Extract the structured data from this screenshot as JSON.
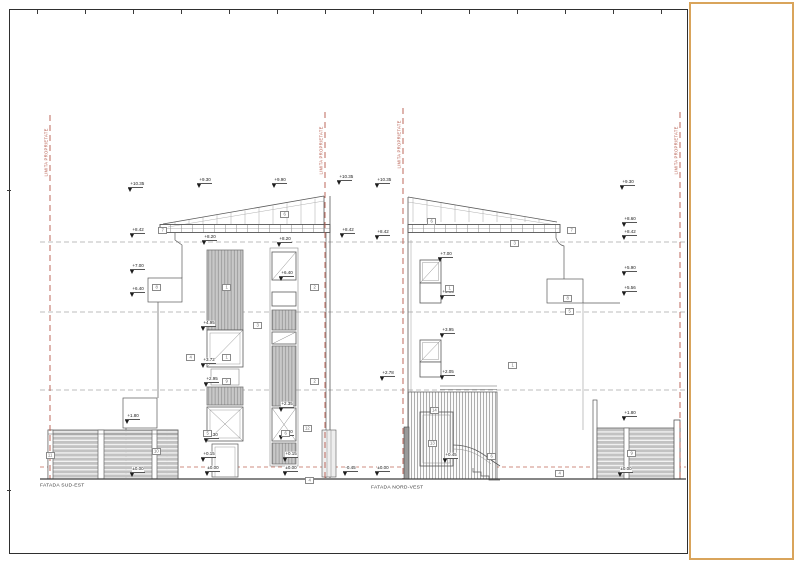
{
  "sheet": {
    "facade_left": "FATADA SUD-EST",
    "facade_right": "FATADA NORD-VEST",
    "property_line_text": "LIMITA PROPRIETATE"
  },
  "colors": {
    "property_line_red": "#b5584a",
    "ground_dash_red": "#c06a5a",
    "level_line_gray": "#a8a8a8",
    "linework": "#5a5a5a",
    "slat_fill": "#c8c8c8",
    "fold_panel_border": "#d9a45b"
  },
  "levels_left": [
    {
      "x": 128,
      "y": 192,
      "v": "+10.35"
    },
    {
      "x": 197,
      "y": 188,
      "v": "+9.30"
    },
    {
      "x": 272,
      "y": 188,
      "v": "+9.90"
    },
    {
      "x": 337,
      "y": 185,
      "v": "+10.35"
    },
    {
      "x": 130,
      "y": 238,
      "v": "+8.42"
    },
    {
      "x": 340,
      "y": 238,
      "v": "+8.42"
    },
    {
      "x": 202,
      "y": 245,
      "v": "+8.20"
    },
    {
      "x": 277,
      "y": 247,
      "v": "+8.20"
    },
    {
      "x": 130,
      "y": 274,
      "v": "+7.00"
    },
    {
      "x": 130,
      "y": 297,
      "v": "+6.40"
    },
    {
      "x": 279,
      "y": 281,
      "v": "+6.40"
    },
    {
      "x": 201,
      "y": 331,
      "v": "+4.95"
    },
    {
      "x": 201,
      "y": 368,
      "v": "+3.72"
    },
    {
      "x": 204,
      "y": 387,
      "v": "+2.95"
    },
    {
      "x": 279,
      "y": 412,
      "v": "+2.35"
    },
    {
      "x": 125,
      "y": 424,
      "v": "+1.80"
    },
    {
      "x": 204,
      "y": 443,
      "v": "+1.30"
    },
    {
      "x": 279,
      "y": 440,
      "v": "+1.30"
    },
    {
      "x": 201,
      "y": 462,
      "v": "+0.15"
    },
    {
      "x": 283,
      "y": 462,
      "v": "+0.15"
    },
    {
      "x": 130,
      "y": 477,
      "v": "±0.00"
    },
    {
      "x": 205,
      "y": 476,
      "v": "±0.00"
    },
    {
      "x": 283,
      "y": 476,
      "v": "±0.00"
    },
    {
      "x": 343,
      "y": 476,
      "v": "-0.45"
    }
  ],
  "levels_right": [
    {
      "x": 375,
      "y": 188,
      "v": "+10.35"
    },
    {
      "x": 620,
      "y": 190,
      "v": "+9.30"
    },
    {
      "x": 622,
      "y": 227,
      "v": "+8.60"
    },
    {
      "x": 375,
      "y": 240,
      "v": "+8.42"
    },
    {
      "x": 622,
      "y": 240,
      "v": "+8.42"
    },
    {
      "x": 438,
      "y": 262,
      "v": "+7.00"
    },
    {
      "x": 440,
      "y": 300,
      "v": "+5.95"
    },
    {
      "x": 622,
      "y": 276,
      "v": "+5.90"
    },
    {
      "x": 622,
      "y": 296,
      "v": "+5.56"
    },
    {
      "x": 440,
      "y": 338,
      "v": "+3.95"
    },
    {
      "x": 380,
      "y": 381,
      "v": "+2.78"
    },
    {
      "x": 440,
      "y": 380,
      "v": "+2.05"
    },
    {
      "x": 622,
      "y": 421,
      "v": "+1.80"
    },
    {
      "x": 443,
      "y": 463,
      "v": "+0.45"
    },
    {
      "x": 375,
      "y": 476,
      "v": "±0.00"
    },
    {
      "x": 618,
      "y": 477,
      "v": "±0.00"
    }
  ],
  "callouts_left": [
    {
      "x": 158,
      "y": 227,
      "n": "7"
    },
    {
      "x": 280,
      "y": 211,
      "n": "6"
    },
    {
      "x": 152,
      "y": 284,
      "n": "8"
    },
    {
      "x": 222,
      "y": 284,
      "n": "1"
    },
    {
      "x": 310,
      "y": 284,
      "n": "2"
    },
    {
      "x": 253,
      "y": 322,
      "n": "3"
    },
    {
      "x": 186,
      "y": 354,
      "n": "4"
    },
    {
      "x": 222,
      "y": 354,
      "n": "1"
    },
    {
      "x": 222,
      "y": 378,
      "n": "9"
    },
    {
      "x": 310,
      "y": 378,
      "n": "2"
    },
    {
      "x": 203,
      "y": 430,
      "n": "5"
    },
    {
      "x": 281,
      "y": 430,
      "n": "6"
    },
    {
      "x": 152,
      "y": 448,
      "n": "10"
    },
    {
      "x": 46,
      "y": 452,
      "n": "11"
    },
    {
      "x": 303,
      "y": 425,
      "n": "12"
    },
    {
      "x": 305,
      "y": 477,
      "n": "4"
    }
  ],
  "callouts_right": [
    {
      "x": 427,
      "y": 218,
      "n": "6"
    },
    {
      "x": 510,
      "y": 240,
      "n": "3"
    },
    {
      "x": 567,
      "y": 227,
      "n": "7"
    },
    {
      "x": 445,
      "y": 285,
      "n": "1"
    },
    {
      "x": 563,
      "y": 295,
      "n": "8"
    },
    {
      "x": 565,
      "y": 308,
      "n": "5"
    },
    {
      "x": 508,
      "y": 362,
      "n": "1"
    },
    {
      "x": 430,
      "y": 407,
      "n": "14"
    },
    {
      "x": 428,
      "y": 440,
      "n": "13"
    },
    {
      "x": 487,
      "y": 453,
      "n": "6"
    },
    {
      "x": 627,
      "y": 450,
      "n": "9"
    },
    {
      "x": 555,
      "y": 470,
      "n": "4"
    }
  ],
  "property_lines": [
    {
      "x": 50,
      "label_y": 118
    },
    {
      "x": 325,
      "label_y": 116
    },
    {
      "x": 403,
      "label_y": 110
    },
    {
      "x": 680,
      "label_y": 116
    }
  ],
  "ruler_ticks": [
    37,
    85,
    133,
    181,
    229,
    277,
    325,
    373,
    421,
    469,
    517,
    565,
    613,
    661
  ],
  "left_border_ticks": [
    190,
    490
  ]
}
